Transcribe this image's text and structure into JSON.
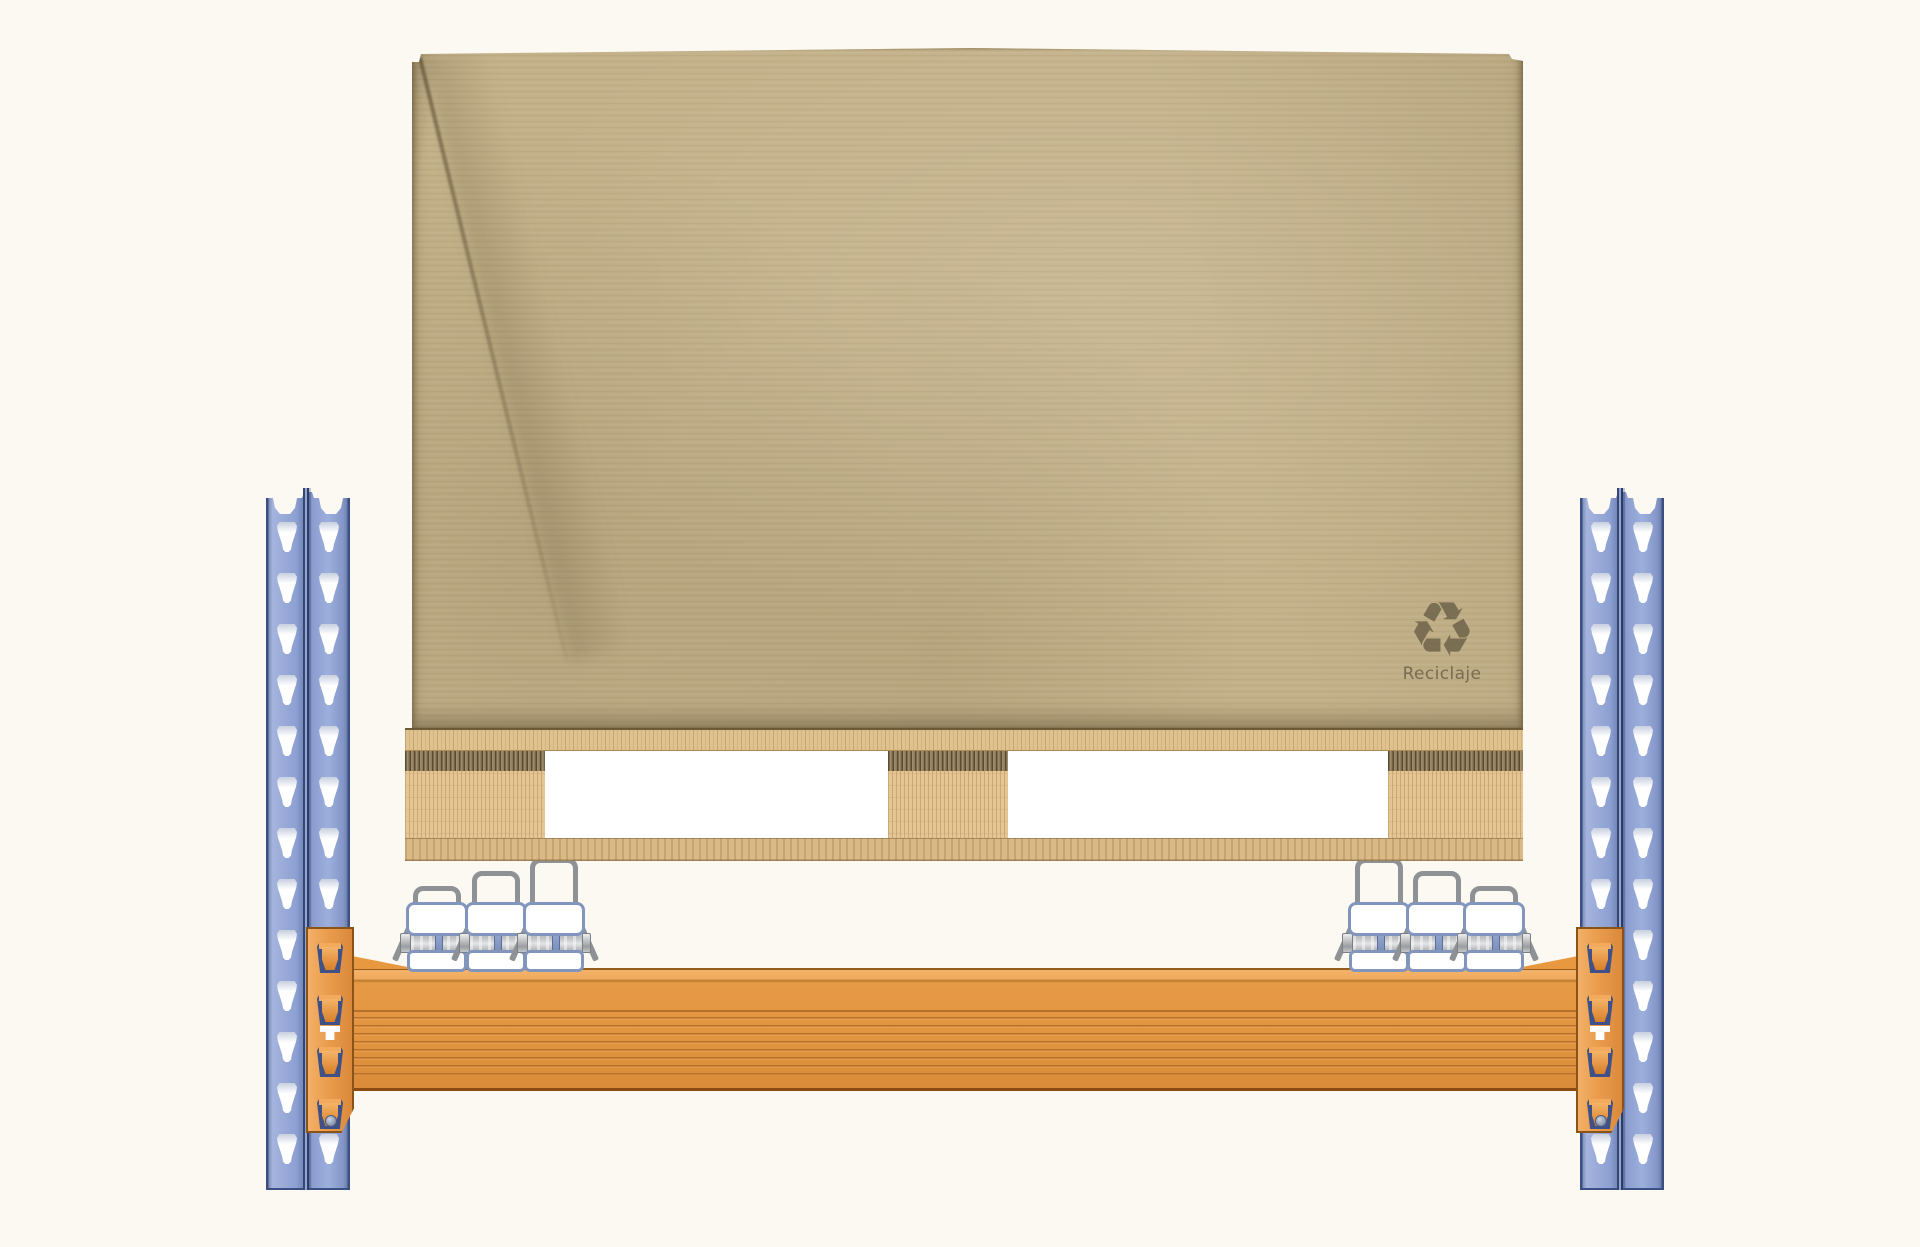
{
  "scene": {
    "title": "Pallet rack bay with kraft-paper-wrapped palletized load resting above a roller beam",
    "background_color": "#fbf9f1"
  },
  "load": {
    "description": "kraft-paper wrapped unit load on wooden pallet",
    "recycle_icon": {
      "name": "recycle-icon",
      "glyph": "♻"
    },
    "recycle_label": "Reciclaje",
    "paper_color": "#c3b189",
    "mark_color": "#6c6148"
  },
  "pallet": {
    "deck_boards": [
      "top",
      "bottom"
    ],
    "wood_light": "#e5c693",
    "wood_mid": "#d9ba86",
    "wood_dark": "#8f7d5c",
    "blocks": [
      {
        "x": 405,
        "w": 140
      },
      {
        "x": 888,
        "w": 120
      },
      {
        "x": 1388,
        "w": 135
      }
    ]
  },
  "rack": {
    "upright_fill": "#8fa2d3",
    "upright_stroke": "#3c4f82",
    "uprights": [
      {
        "side": "left",
        "x": 266
      },
      {
        "side": "right",
        "x": 1580
      }
    ],
    "slot_rows": 13,
    "slot_cols_offsets": [
      11,
      53
    ],
    "slot_first_top": 34,
    "slot_pitch": 51,
    "beam": {
      "fill": "#e29440",
      "stroke": "#8a4c12"
    },
    "brackets": [
      {
        "side": "left",
        "x": 306
      },
      {
        "side": "right",
        "x": 1576
      }
    ],
    "bracket_fill": "#e99c4b",
    "hook_offsets": [
      16,
      68,
      120,
      172
    ]
  },
  "rollers": {
    "steel_color": "#8f9295",
    "bracket_outline": "#8296bd",
    "beam_top_y": 968,
    "units": [
      {
        "group": "left",
        "x": 437,
        "h": 82
      },
      {
        "group": "left",
        "x": 496,
        "h": 97
      },
      {
        "group": "left",
        "x": 554,
        "h": 110
      },
      {
        "group": "right",
        "x": 1379,
        "h": 110
      },
      {
        "group": "right",
        "x": 1437,
        "h": 97
      },
      {
        "group": "right",
        "x": 1494,
        "h": 82
      }
    ]
  }
}
